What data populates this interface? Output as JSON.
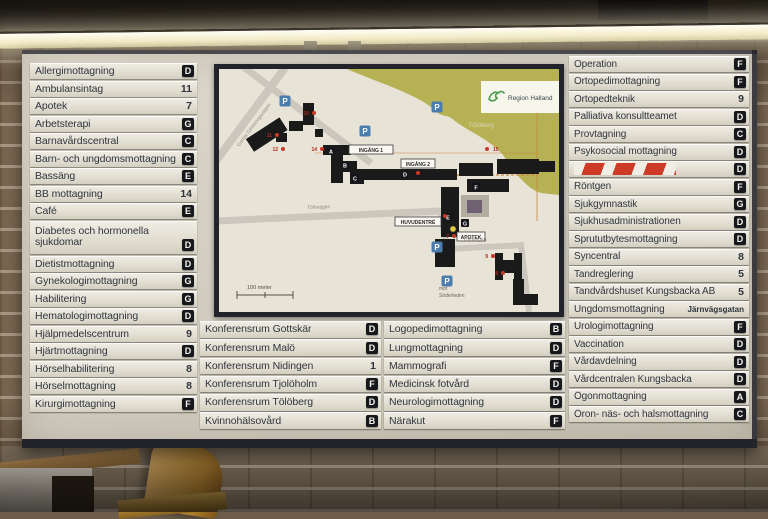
{
  "board": {
    "left_column": {
      "items": [
        {
          "label": "Allergimottagning",
          "value": "D",
          "kind": "letter"
        },
        {
          "label": "Ambulansintag",
          "value": "11",
          "kind": "number"
        },
        {
          "label": "Apotek",
          "value": "7",
          "kind": "number"
        },
        {
          "label": "Arbetsterapi",
          "value": "G",
          "kind": "letter"
        },
        {
          "label": "Barnavårdscentral",
          "value": "C",
          "kind": "letter"
        },
        {
          "label": "Barn- och ungdomsmottagning",
          "value": "C",
          "kind": "letter"
        },
        {
          "label": "Bassäng",
          "value": "E",
          "kind": "letter"
        },
        {
          "label": "BB mottagning",
          "value": "14",
          "kind": "number"
        },
        {
          "label": "Café",
          "value": "E",
          "kind": "letter"
        },
        {
          "label": "Diabetes och hormonella sjukdomar",
          "value": "D",
          "kind": "letter",
          "tall": true
        },
        {
          "label": "Dietistmottagning",
          "value": "D",
          "kind": "letter"
        },
        {
          "label": "Gynekologimottagning",
          "value": "G",
          "kind": "letter"
        },
        {
          "label": "Habilitering",
          "value": "G",
          "kind": "letter"
        },
        {
          "label": "Hematologimottagning",
          "value": "D",
          "kind": "letter"
        },
        {
          "label": "Hjälpmedelscentrum",
          "value": "9",
          "kind": "number"
        },
        {
          "label": "Hjärtmottagning",
          "value": "D",
          "kind": "letter"
        },
        {
          "label": "Hörselhabilitering",
          "value": "8",
          "kind": "number"
        },
        {
          "label": "Hörselmottagning",
          "value": "8",
          "kind": "number"
        },
        {
          "label": "Kirurgimottagning",
          "value": "F",
          "kind": "letter"
        }
      ]
    },
    "right_column": {
      "items": [
        {
          "label": "Operation",
          "value": "F",
          "kind": "letter"
        },
        {
          "label": "Ortopedimottagning",
          "value": "F",
          "kind": "letter"
        },
        {
          "label": "Ortopedteknik",
          "value": "9",
          "kind": "number"
        },
        {
          "label": "Palliativa konsultteamet",
          "value": "D",
          "kind": "letter"
        },
        {
          "label": "Provtagning",
          "value": "C",
          "kind": "letter"
        },
        {
          "label": "Psykosocial mottagning",
          "value": "D",
          "kind": "letter"
        },
        {
          "label": "",
          "value": "D",
          "kind": "letter",
          "stripes": true
        },
        {
          "label": "Röntgen",
          "value": "F",
          "kind": "letter"
        },
        {
          "label": "Sjukgymnastik",
          "value": "G",
          "kind": "letter"
        },
        {
          "label": "Sjukhusadministrationen",
          "value": "D",
          "kind": "letter"
        },
        {
          "label": "Sprututbytesmottagning",
          "value": "D",
          "kind": "letter"
        },
        {
          "label": "Syncentral",
          "value": "8",
          "kind": "number"
        },
        {
          "label": "Tandreglering",
          "value": "5",
          "kind": "number"
        },
        {
          "label": "Tandvårdshuset Kungsbacka AB",
          "value": "5",
          "kind": "number"
        },
        {
          "label": "Ungdomsmottagning",
          "value": "Järnvägsgatan",
          "kind": "text"
        },
        {
          "label": "Urologimottagning",
          "value": "F",
          "kind": "letter"
        },
        {
          "label": "Vaccination",
          "value": "D",
          "kind": "letter"
        },
        {
          "label": "Vårdavdelning",
          "value": "D",
          "kind": "letter"
        },
        {
          "label": "Vårdcentralen Kungsbacka",
          "value": "D",
          "kind": "letter"
        },
        {
          "label": "Ögonmottagning",
          "value": "A",
          "kind": "letter"
        },
        {
          "label": "Öron- näs- och halsmottagning",
          "value": "C",
          "kind": "letter"
        }
      ]
    },
    "bottom_left_column": {
      "items": [
        {
          "label": "Konferensrum Gottskär",
          "value": "D",
          "kind": "letter"
        },
        {
          "label": "Konferensrum Malö",
          "value": "D",
          "kind": "letter"
        },
        {
          "label": "Konferensrum Nidingen",
          "value": "1",
          "kind": "number"
        },
        {
          "label": "Konferensrum Tjolöholm",
          "value": "F",
          "kind": "letter"
        },
        {
          "label": "Konferensrum Tölöberg",
          "value": "D",
          "kind": "letter"
        },
        {
          "label": "Kvinnohälsovård",
          "value": "B",
          "kind": "letter"
        }
      ]
    },
    "bottom_right_column": {
      "items": [
        {
          "label": "Logopedimottagning",
          "value": "B",
          "kind": "letter"
        },
        {
          "label": "Lungmottagning",
          "value": "D",
          "kind": "letter"
        },
        {
          "label": "Mammografi",
          "value": "F",
          "kind": "letter"
        },
        {
          "label": "Medicinsk fotvård",
          "value": "D",
          "kind": "letter"
        },
        {
          "label": "Neurologimottagning",
          "value": "D",
          "kind": "letter"
        },
        {
          "label": "Närakut",
          "value": "F",
          "kind": "letter"
        }
      ]
    },
    "map": {
      "logo": "Region Halland",
      "hill": "Tölöberg",
      "entrance1": "INGÅNG 1",
      "entrance2": "INGÅNG 2",
      "main_entrance": "HUVUDENTRÉ",
      "pharmacy": "APOTEK",
      "road_gamla": "Gamla Göteborgsvägen",
      "road_tolovagen": "Tölövägen",
      "road_soder_1": "mot",
      "road_soder_2": "Söderleden",
      "scale": "100 meter",
      "parking": "P",
      "badges": {
        "a": "A",
        "b": "B",
        "c": "C",
        "d": "D",
        "e": "E",
        "f": "F",
        "g": "G"
      },
      "dots": {
        "d7": "7",
        "d8": "8",
        "d9": "9",
        "d10": "10",
        "d11": "11",
        "d12": "12",
        "d14": "14",
        "d15": "15"
      }
    },
    "colors": {
      "badge_bg": "#17181c",
      "alert_red": "#cd3a26",
      "parking_blue": "#4a7dad",
      "map_green": "#b6b254",
      "board_bg": "#d6d2c6"
    }
  }
}
